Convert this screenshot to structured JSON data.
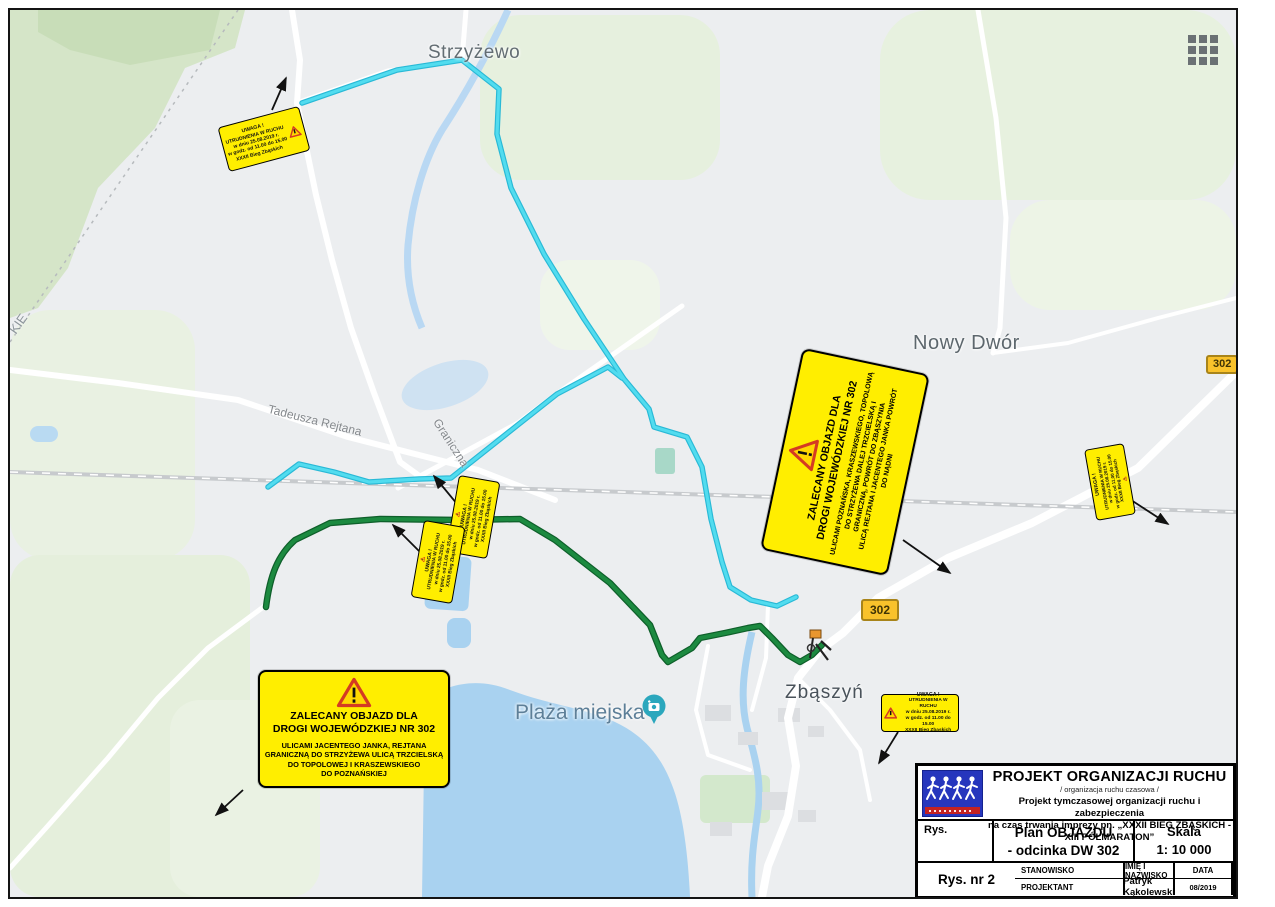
{
  "map": {
    "place_labels": {
      "strzyzewo": "Strzyżewo",
      "nowy_dwor": "Nowy Dwór",
      "zbaszyn": "Zbąszyń",
      "plaza_miejska": "Plaża miejska"
    },
    "street_labels": {
      "rejtana": "Tadeusza Rejtana",
      "graniczna": "Graniczna",
      "edge_partial": "KIE"
    },
    "road_shields": [
      "302",
      "302"
    ]
  },
  "signs": {
    "detour_sign_southwest": {
      "title": [
        "ZALECANY OBJAZD DLA",
        "DROGI WOJEWÓDZKIEJ NR 302"
      ],
      "body": [
        "ULICAMI JACENTEGO JANKA, REJTANA",
        "GRANICZNĄ DO STRZYŻEWA ULICĄ TRZCIELSKĄ",
        "DO TOPOLOWEJ I KRASZEWSKIEGO",
        "DO POZNAŃSKIEJ"
      ]
    },
    "detour_sign_east": {
      "title": [
        "ZALECANY OBJAZD DLA",
        "DROGI WOJEWÓDZKIEJ NR 302"
      ],
      "body": [
        "ULICAMI POZNAŃSKA, KRASZEWSKIEGO, TOPOLOWĄ",
        "DO STRZYŻEWA DALEJ TRZCIELSKĄ I",
        "GRANICZNĄ, POWRÓT DO ZBĄSZYNIA",
        "ULICĄ REJTANA I JACENTEGO JANKA POWRÓT",
        "DO NĄDNI"
      ]
    },
    "small_warning_sign": {
      "lines": [
        "UWAGA !",
        "UTRUDNIENIA W RUCHU",
        "w dniu 25.08.2019 r.",
        "w godz. od 11.00 do 15.00",
        "XXXII Bieg Zbąskich"
      ]
    }
  },
  "title_block": {
    "title": "PROJEKT ORGANIZACJI RUCHU",
    "subtitle": "/ organizacja ruchu czasowa /",
    "desc": [
      "Projekt tymczasowej organizacji ruchu i zabezpieczenia",
      "na czas trwania imprezy pn. „XXXII BIEG ZBĄSKICH - XIII PÓŁMARATON”"
    ],
    "rys_label": "Rys.",
    "drawing_title": [
      "Plan OBJAZDU",
      "- odcinka DW 302"
    ],
    "scale_label": "Skala",
    "scale_value": "1: 10 000",
    "col_position": "STANOWISKO",
    "col_name": "IMIĘ I NAZWISKO",
    "col_date": "DATA",
    "drawing_no": "Rys. nr 2",
    "role": "PROJEKTANT",
    "designer": "Patryk Kąkolewski",
    "date": "08/2019"
  },
  "icons": {
    "warning_triangle": "red-bordered warning triangle with exclamation mark",
    "apps_grid": "3x3 dots grid",
    "camera_pin": "teal photo POI pin",
    "runner_marker": "small runner/finish marker",
    "logo": "blue runners logo with red banner"
  },
  "colors": {
    "detour_route_cyan": "#3bcfe5",
    "race_route_green": "#1c8a40",
    "sign_yellow": "#ffee00",
    "shield_amber": "#f9c22b",
    "water_blue": "#a9d2f0",
    "vegetation_green": "#e6f0de",
    "logo_blue": "#2636bd",
    "logo_red": "#c32222"
  }
}
